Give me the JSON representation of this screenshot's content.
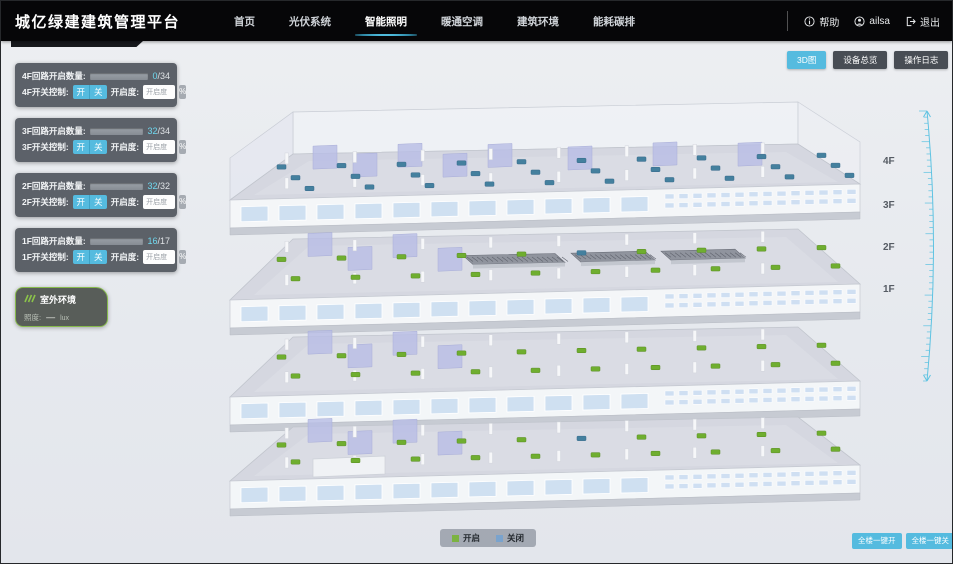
{
  "header": {
    "title": "城亿绿建建筑管理平台",
    "nav_items": [
      {
        "label": "首页",
        "active": false
      },
      {
        "label": "光伏系统",
        "active": false
      },
      {
        "label": "智能照明",
        "active": true
      },
      {
        "label": "暖通空调",
        "active": false
      },
      {
        "label": "建筑环境",
        "active": false
      },
      {
        "label": "能耗碳排",
        "active": false
      }
    ],
    "help_label": "帮助",
    "username": "ailsa",
    "logout_label": "退出"
  },
  "toolbar": {
    "buttons": [
      {
        "label": "3D图",
        "active": true
      },
      {
        "label": "设备总览",
        "active": false
      },
      {
        "label": "操作日志",
        "active": false
      }
    ]
  },
  "floor_panels": [
    {
      "floor": "4F",
      "count_label": "4F回路开启数量:",
      "open_count": 0,
      "total_count": 34,
      "total_display": "/34",
      "switch_label": "4F开关控制:",
      "on_label": "开",
      "off_label": "关",
      "dimming_label": "开启度:",
      "dimming_placeholder": "开启度",
      "unit_label": "%"
    },
    {
      "floor": "3F",
      "count_label": "3F回路开启数量:",
      "open_count": 32,
      "total_count": 34,
      "total_display": "/34",
      "switch_label": "3F开关控制:",
      "on_label": "开",
      "off_label": "关",
      "dimming_label": "开启度:",
      "dimming_placeholder": "开启度",
      "unit_label": "%"
    },
    {
      "floor": "2F",
      "count_label": "2F回路开启数量:",
      "open_count": 32,
      "total_count": 32,
      "total_display": "/32",
      "switch_label": "2F开关控制:",
      "on_label": "开",
      "off_label": "关",
      "dimming_label": "开启度:",
      "dimming_placeholder": "开启度",
      "unit_label": "%"
    },
    {
      "floor": "1F",
      "count_label": "1F回路开启数量:",
      "open_count": 16,
      "total_count": 17,
      "total_display": "/17",
      "switch_label": "1F开关控制:",
      "on_label": "开",
      "off_label": "关",
      "dimming_label": "开启度:",
      "dimming_placeholder": "开启度",
      "unit_label": "%"
    }
  ],
  "outdoor_panel": {
    "title": "室外环境",
    "metric_label": "照度:",
    "metric_value": "—",
    "metric_unit": "lux"
  },
  "building": {
    "floor_labels": [
      "4F",
      "3F",
      "2F",
      "1F"
    ]
  },
  "legend": {
    "items": [
      {
        "label": "开启",
        "color": "#7cb342"
      },
      {
        "label": "关闭",
        "color": "#7aa3cd"
      }
    ]
  },
  "bulk_actions": [
    {
      "label": "全楼一键开"
    },
    {
      "label": "全楼一键关"
    }
  ],
  "colors": {
    "accent": "#55bbdf",
    "progress_fill": "#5ecbe8",
    "marker_on": "#6fae2f",
    "marker_off": "#44809e"
  }
}
